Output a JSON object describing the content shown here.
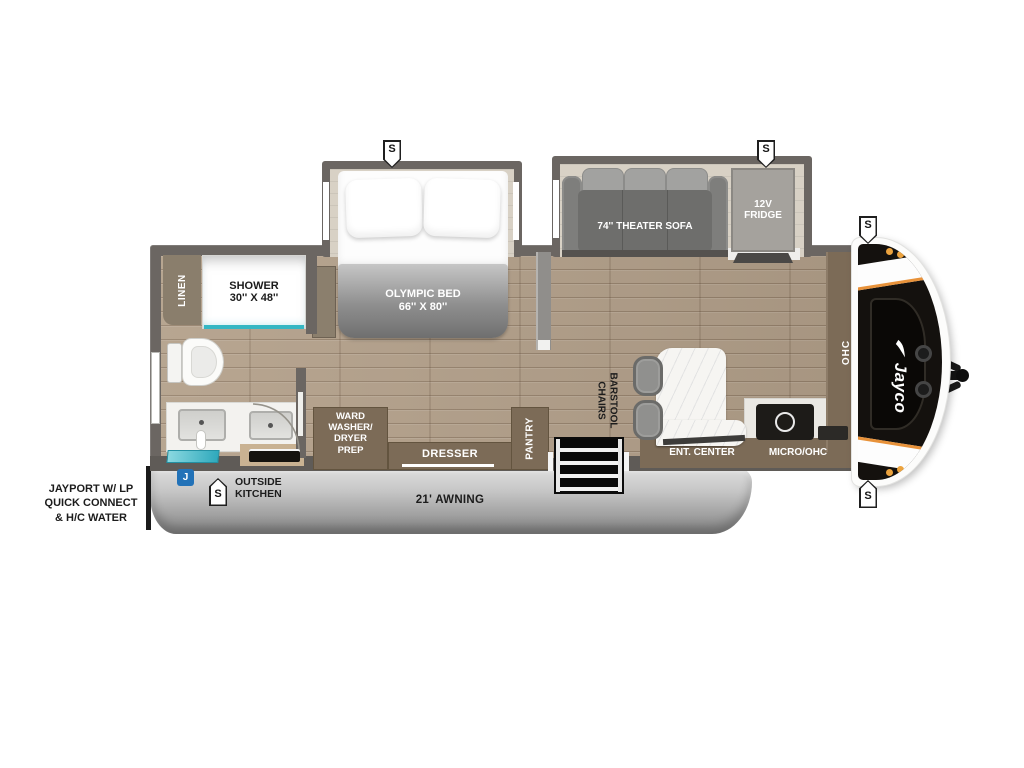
{
  "plan": {
    "brand": "Jayco",
    "markers": {
      "speaker": "S",
      "jayport": "J"
    },
    "labels": {
      "awning": "21' AWNING",
      "jayport_l1": "JAYPORT W/ LP",
      "jayport_l2": "QUICK CONNECT",
      "jayport_l3": "& H/C WATER",
      "outside_kitchen_l1": "OUTSIDE",
      "outside_kitchen_l2": "KITCHEN",
      "linen": "LINEN",
      "shower_l1": "SHOWER",
      "shower_l2": "30'' X 48''",
      "olympic_bed_l1": "OLYMPIC BED",
      "olympic_bed_l2": "66'' X 80''",
      "theater_sofa": "74'' THEATER SOFA",
      "fridge_l1": "12V",
      "fridge_l2": "FRIDGE",
      "ward_l1": "WARD",
      "ward_l2": "WASHER/",
      "ward_l3": "DRYER",
      "ward_l4": "PREP",
      "dresser": "DRESSER",
      "pantry": "PANTRY",
      "barstool_l1": "BARSTOOL",
      "barstool_l2": "CHAIRS",
      "ent_center": "ENT. CENTER",
      "micro_ohc": "MICRO/OHC",
      "ohc": "OHC"
    },
    "colors": {
      "wall": "#6b6662",
      "cabinet": "#7c6b57",
      "wood_floor": "#b3a08a",
      "slide_floor": "#d8d1c5",
      "teal_accent": "#35b7c3",
      "marker_blue": "#2272b8",
      "cap_black": "#14110e",
      "accent_orange": "#e8923a",
      "awning_gray": "#9b9b9b"
    }
  }
}
